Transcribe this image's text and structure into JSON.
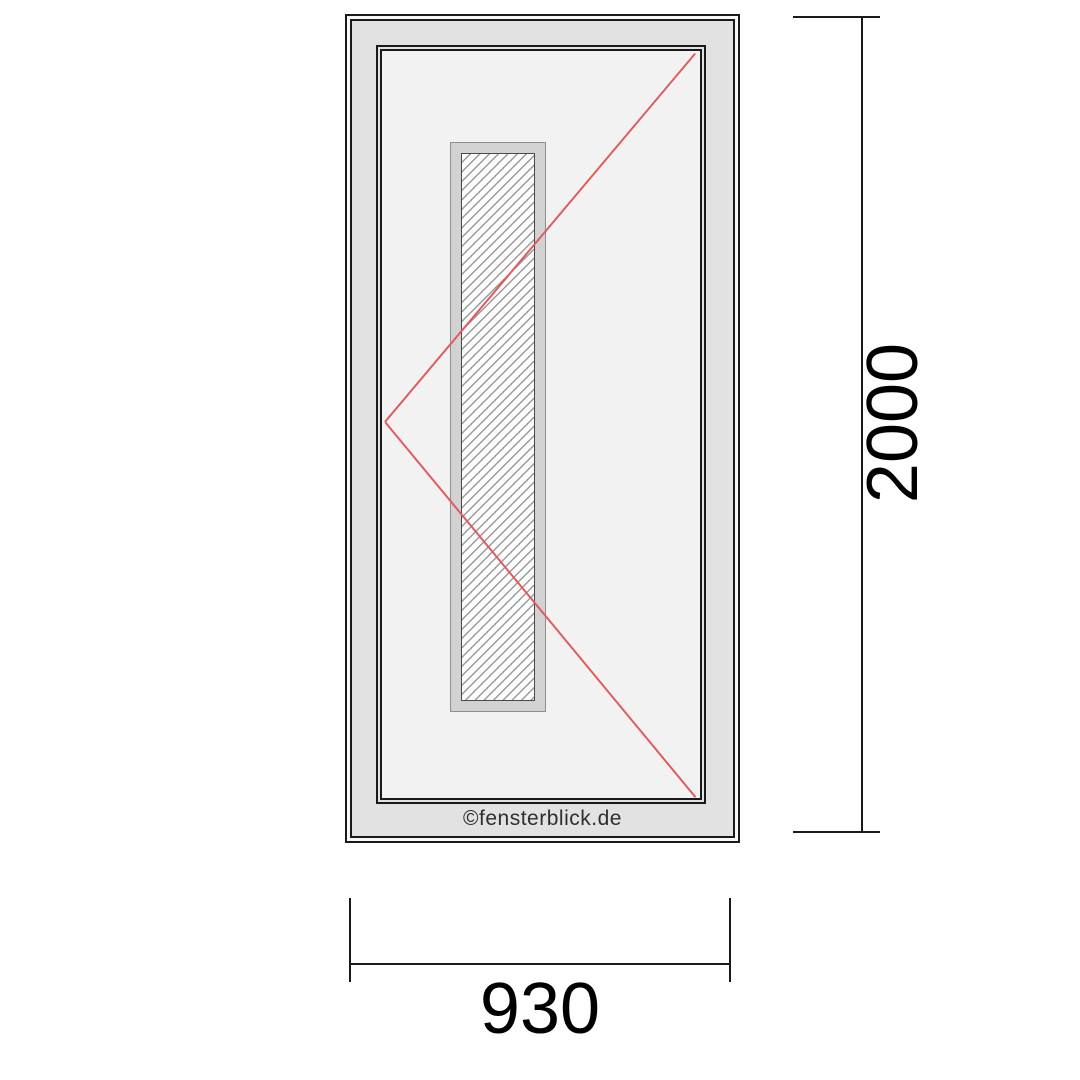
{
  "diagram": {
    "kind": "front-door elevation drawing",
    "watermark": {
      "text": "©fensterblick.de"
    },
    "dimensions": {
      "height": {
        "label": "2000"
      },
      "width": {
        "label": "930"
      }
    },
    "door": {
      "glazing": {
        "style": "vertical hatched glass strip",
        "hatch_direction": "diagonal-45deg"
      },
      "opening_indicator": {
        "shape": "two red lines meeting at left mid-height (DIN opening direction)",
        "color": "#e05c5c"
      }
    },
    "colors": {
      "line_black": "#1a1a1a",
      "frame_gray": "#e2e2e2",
      "sash_fill": "#f2f2f2",
      "glazing_bead": "#d2d2d2",
      "hatch_gray": "#9a9a9a",
      "opening_red": "#e05c5c",
      "background": "#ffffff"
    }
  }
}
